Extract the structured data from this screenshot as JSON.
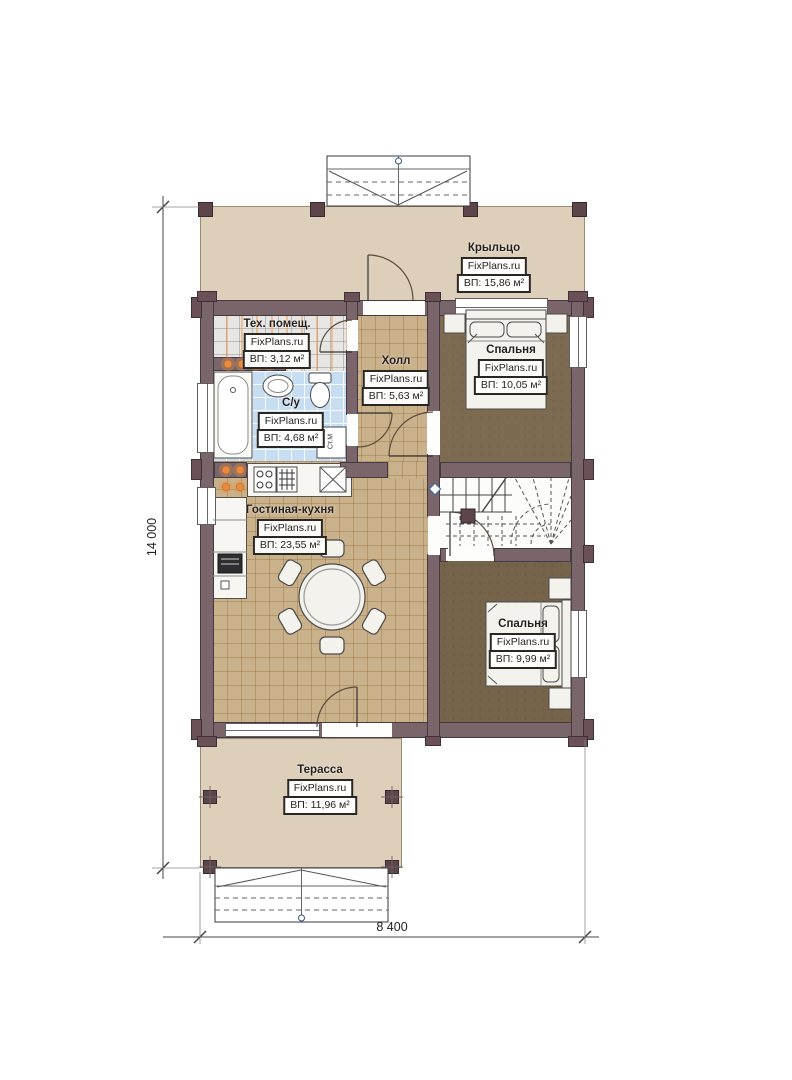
{
  "watermark": "FixPlans.ru",
  "rooms": [
    {
      "id": "porch",
      "name": "Крыльцо",
      "area": "ВП: 15,86 м²"
    },
    {
      "id": "tech-room",
      "name": "Тех. помещ.",
      "area": "ВП: 3,12 м²"
    },
    {
      "id": "hall",
      "name": "Холл",
      "area": "ВП: 5,63 м²"
    },
    {
      "id": "bedroom-top",
      "name": "Спальня",
      "area": "ВП: 10,05 м²"
    },
    {
      "id": "bathroom",
      "name": "С/у",
      "area": "ВП: 4,68 м²"
    },
    {
      "id": "living-kitchen",
      "name": "Гостиная-кухня",
      "area": "ВП: 23,55 м²"
    },
    {
      "id": "bedroom-bottom",
      "name": "Спальня",
      "area": "ВП: 9,99 м²"
    },
    {
      "id": "terrace",
      "name": "Терасса",
      "area": "ВП: 11,96 м²"
    }
  ],
  "dimensions": {
    "vertical": "14 000",
    "horizontal": "8 400"
  },
  "annotations": {
    "washing_machine": "Ст.М"
  },
  "colors": {
    "wall": "#7a656b",
    "porch_floor": "#ddcfba",
    "tile_tan": "#c9b18b",
    "tile_blue": "#c7ddf1",
    "wood_dark": "#7d6b51",
    "log_end_orange": "#e88a3f"
  }
}
